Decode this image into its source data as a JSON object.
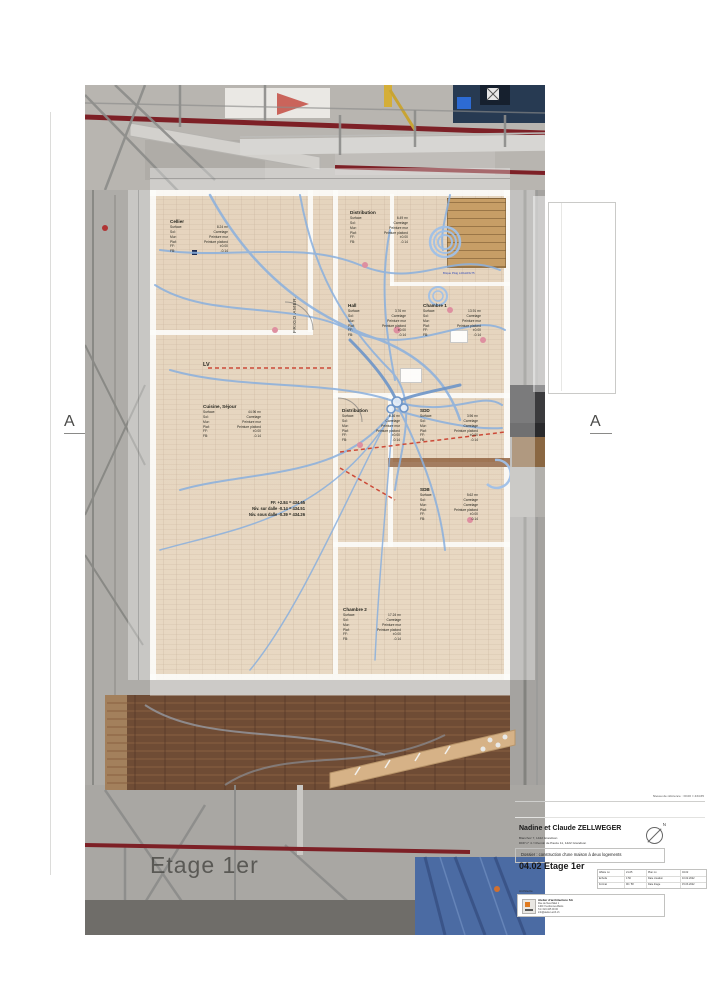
{
  "section_markers": {
    "left": "A",
    "right": "A"
  },
  "watermark": "Etage 1er",
  "plan": {
    "labels": {
      "surface": "Surface:",
      "sol": "Sol:",
      "mur": "Mur:",
      "plaf": "Plaf:",
      "ff": "FF:",
      "fb": "FB:"
    },
    "rooms": [
      {
        "name": "Cellier",
        "surface": "8.24 m²",
        "sol": "Carrelage",
        "mur": "Peinture mur",
        "plaf": "Peinture plafond",
        "ff": "±0.00",
        "fb": "-0.14"
      },
      {
        "name": "Distribution",
        "surface": "6.49 m²",
        "sol": "Carrelage",
        "mur": "Peinture mur",
        "plaf": "Peinture plafond",
        "ff": "±0.00",
        "fb": "-0.14"
      },
      {
        "name": "Hall",
        "surface": "3.76 m²",
        "sol": "Carrelage",
        "mur": "Peinture mur",
        "plaf": "Peinture plafond",
        "ff": "±0.00",
        "fb": "-0.14"
      },
      {
        "name": "Chambre 1",
        "surface": "13.91 m²",
        "sol": "Carrelage",
        "mur": "Peinture mur",
        "plaf": "Peinture plafond",
        "ff": "±0.00",
        "fb": "-0.14"
      },
      {
        "name": "Cuisine, Séjour",
        "surface": "44.96 m²",
        "sol": "Carrelage",
        "mur": "Peinture mur",
        "plaf": "Peinture plafond",
        "ff": "±0.00",
        "fb": "-0.14"
      },
      {
        "name": "Distribution",
        "surface": "6.36 m²",
        "sol": "Carrelage",
        "mur": "Peinture mur",
        "plaf": "Peinture plafond",
        "ff": "±0.00",
        "fb": "-0.14"
      },
      {
        "name": "SDD",
        "surface": "3.96 m²",
        "sol": "Carrelage",
        "mur": "Carrelage",
        "plaf": "Peinture plafond",
        "ff": "±0.00",
        "fb": "-0.14"
      },
      {
        "name": "SDB",
        "surface": "5.62 m²",
        "sol": "Carrelage",
        "mur": "Carrelage",
        "plaf": "Peinture plafond",
        "ff": "±0.00",
        "fb": "-0.14"
      },
      {
        "name": "Chambre 2",
        "surface": "17.24 m²",
        "sol": "Carrelage",
        "mur": "Peinture mur",
        "plaf": "Peinture plafond",
        "ff": "±0.00",
        "fb": "-0.14"
      }
    ],
    "levels": [
      "FF. +2.84 = 434.65",
      "Niv. sur dalle -0.14 = 434.51",
      "Niv. sous dalle -0.39 = 434.26"
    ],
    "annotations": {
      "frigo": "FRIGO AMER.",
      "lv": "LV",
      "brique": "Brique Plstg L40xH15x75"
    }
  },
  "titleblock": {
    "reference": "Niveau de référence : ±0.00 = 434.65",
    "client": "Nadine et Claude ZELLWEGER",
    "address1": "Blanchoz 7, 1422 Grandson",
    "address2": "DDP n° 4 / Chemin de Pauze 11, 1422 Grandson",
    "project": "Dossier : construction d'une maison à deux logements",
    "plan_title": "04.02 Etage 1er",
    "compass_n": "N",
    "grid": [
      [
        "Affaire no",
        "21-05",
        "Plan no",
        "04.02"
      ],
      [
        "Echelle",
        "1:50",
        "Date création",
        "10.02.2022"
      ],
      [
        "Format",
        "90 / 58",
        "Date tirage",
        "15.03.2022"
      ]
    ],
    "architect_label": "Architecte",
    "architect": {
      "name": "Atelier d'architecture SA",
      "lines": [
        "Rue de Neuchâtel 1",
        "1400 Yverdon-les-Bains",
        "Tél. 024 425 00 00",
        "info@atelier-arch.ch"
      ]
    }
  }
}
